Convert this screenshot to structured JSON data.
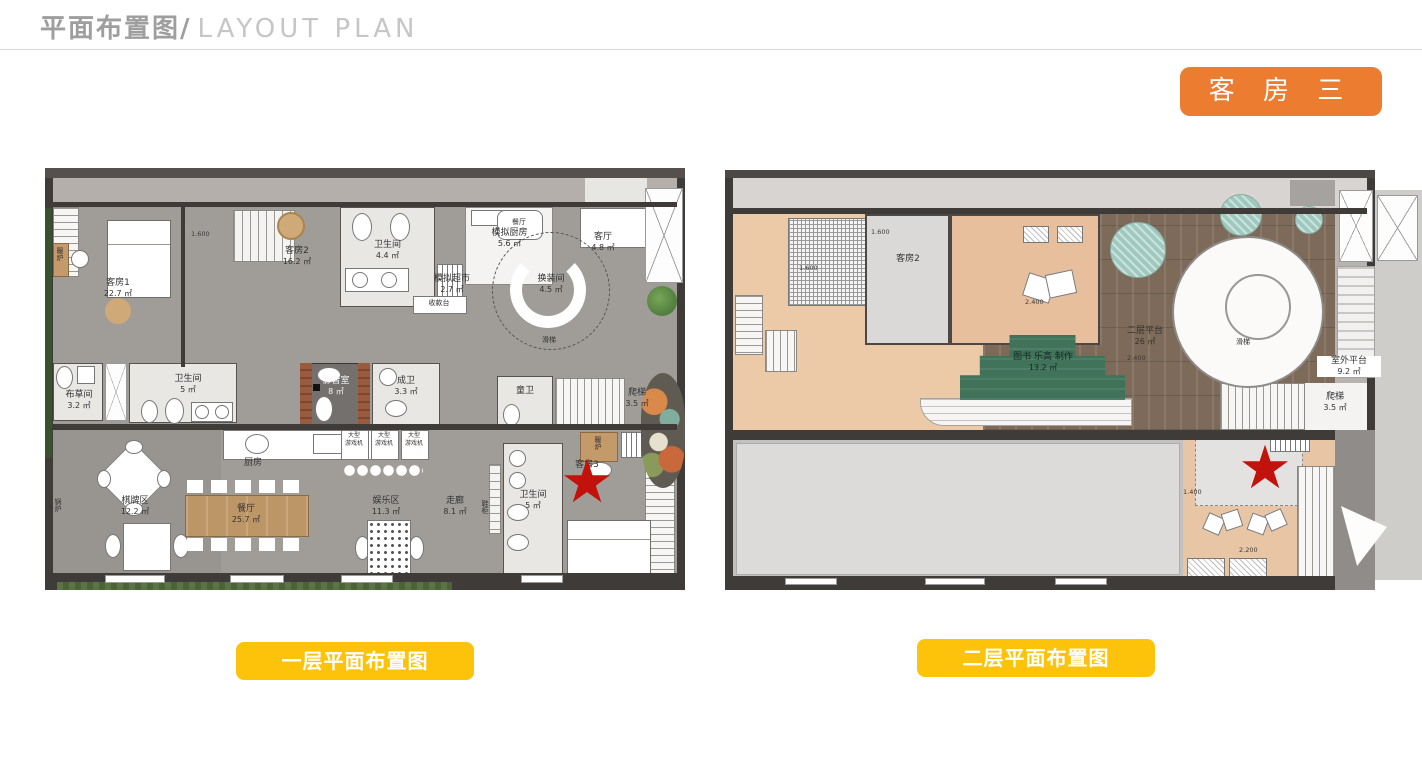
{
  "header": {
    "title_zh": "平面布置图/",
    "title_en": "LAYOUT  PLAN"
  },
  "badge": {
    "label": "客 房 三",
    "color": "#ec7c30"
  },
  "star": "★",
  "colors": {
    "accent_orange": "#ec7c30",
    "accent_yellow": "#fdc20a",
    "star_red": "#c1120c"
  },
  "plans": {
    "first": {
      "button_label": "一层平面布置图",
      "labels": {
        "kefang1": {
          "name": "客房1",
          "area": "22.7 ㎡"
        },
        "kefang2": {
          "name": "客房2",
          "area": "16.2 ㎡"
        },
        "wc_top": {
          "name": "卫生间",
          "area": "4.4 ㎡"
        },
        "moni_kitchen": {
          "name": "模拟厨房",
          "area": "5.6 ㎡"
        },
        "moni_market": {
          "name": "模拟超市",
          "area": "2.7 ㎡"
        },
        "checkout": {
          "name": "收款台"
        },
        "dining_small": {
          "name": "餐厅"
        },
        "living": {
          "name": "客厅",
          "area": "4.8 ㎡"
        },
        "changing": {
          "name": "换装间",
          "area": "4.5 ㎡"
        },
        "slide": {
          "name": "滑梯"
        },
        "linen": {
          "name": "布草间",
          "area": "3.2 ㎡"
        },
        "wc_mid": {
          "name": "卫生间",
          "area": "5 ㎡"
        },
        "media": {
          "name": "影音室",
          "area": "8 ㎡"
        },
        "adult_wc": {
          "name": "成卫",
          "area": "3.3 ㎡"
        },
        "kids_wc": {
          "name": "童卫"
        },
        "stairs": {
          "name": "爬梯",
          "area": "3.5 ㎡"
        },
        "heater_left": {
          "name": "暖炉"
        },
        "heater_right": {
          "name": "暖炉"
        },
        "chess": {
          "name": "棋牌区",
          "area": "12.2 ㎡"
        },
        "kitchen": {
          "name": "厨房"
        },
        "dining": {
          "name": "餐厅",
          "area": "25.7 ㎡"
        },
        "arcade": {
          "line1": "大型",
          "line2": "游戏机"
        },
        "play": {
          "name": "娱乐区",
          "area": "11.3 ㎡"
        },
        "corridor": {
          "name": "走廊",
          "area": "8.1 ㎡"
        },
        "shoe": {
          "name": "鞋柜"
        },
        "boiler": {
          "name": "锅炉"
        },
        "wc_br": {
          "name": "卫生间",
          "area": "5 ㎡"
        },
        "kefang3": {
          "name": "客房3"
        }
      },
      "levels": {
        "a": "1.600"
      }
    },
    "second": {
      "button_label": "二层平面布置图",
      "labels": {
        "kefang2": {
          "name": "客房2"
        },
        "platform": {
          "name": "二层平台",
          "area": "26 ㎡"
        },
        "lego": {
          "name": "图书 乐高 制作",
          "area": "13.2 ㎡"
        },
        "slide": {
          "name": "滑梯"
        },
        "outdoor": {
          "name": "室外平台",
          "area": "9.2 ㎡"
        },
        "stairs": {
          "name": "爬梯",
          "area": "3.5 ㎡"
        }
      },
      "levels": {
        "a": "1.600",
        "b": "1.600",
        "c": "2.400",
        "d": "2.400",
        "e": "1.400",
        "f": "2.200"
      }
    }
  }
}
